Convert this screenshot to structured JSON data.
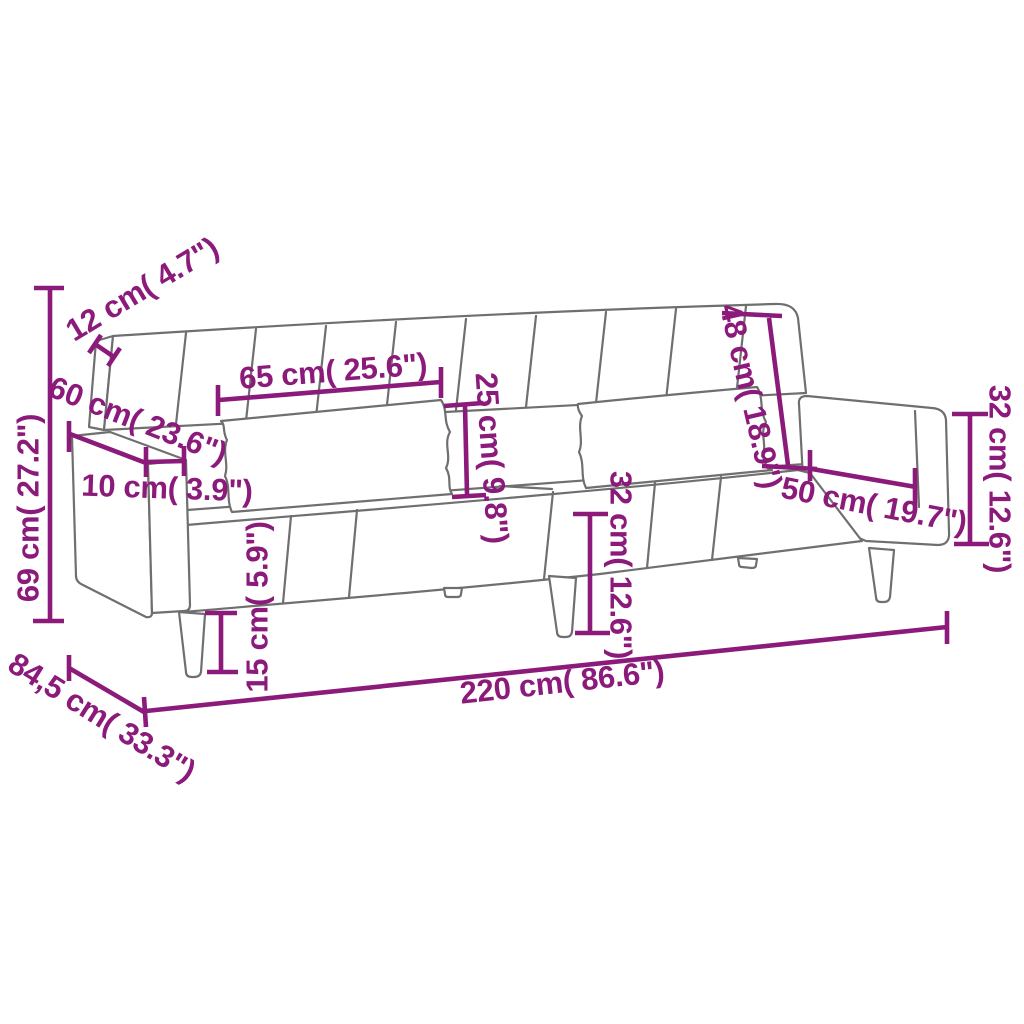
{
  "diagram": {
    "subject": "two-seater sofa bed dimension diagram with armrests and two pillows",
    "background": "#FFFFFF",
    "outline_color": "#6F6F6F",
    "dimension_color": "#8B1A7B"
  },
  "dims": {
    "d12": {
      "cm": "12",
      "inches": "4.7",
      "label": "12 cm( 4.7\")"
    },
    "d69": {
      "cm": "69",
      "inches": "27.2",
      "label": "69 cm( 27.2\")"
    },
    "d60": {
      "cm": "60",
      "inches": "23.6",
      "label": "60 cm( 23.6\")"
    },
    "d10": {
      "cm": "10",
      "inches": "3.9",
      "label": "10 cm( 3.9\")"
    },
    "d65": {
      "cm": "65",
      "inches": "25.6",
      "label": "65 cm( 25.6\")"
    },
    "d25": {
      "cm": "25",
      "inches": "9.8",
      "label": "25 cm( 9.8\")"
    },
    "d48": {
      "cm": "48",
      "inches": "18.9",
      "label": "48 cm( 18.9\")"
    },
    "d32r": {
      "cm": "32",
      "inches": "12.6",
      "label": "32 cm( 12.6\")"
    },
    "d50": {
      "cm": "50",
      "inches": "19.7",
      "label": "50 cm( 19.7\")"
    },
    "d32m": {
      "cm": "32",
      "inches": "12.6",
      "label": "32 cm( 12.6\")"
    },
    "d15": {
      "cm": "15",
      "inches": "5.9",
      "label": "15 cm( 5.9\")"
    },
    "d845": {
      "cm": "84,5",
      "inches": "33.3",
      "label": "84,5 cm( 33.3\")"
    },
    "d220": {
      "cm": "220",
      "inches": "86.6",
      "label": "220 cm( 86.6\")"
    }
  }
}
